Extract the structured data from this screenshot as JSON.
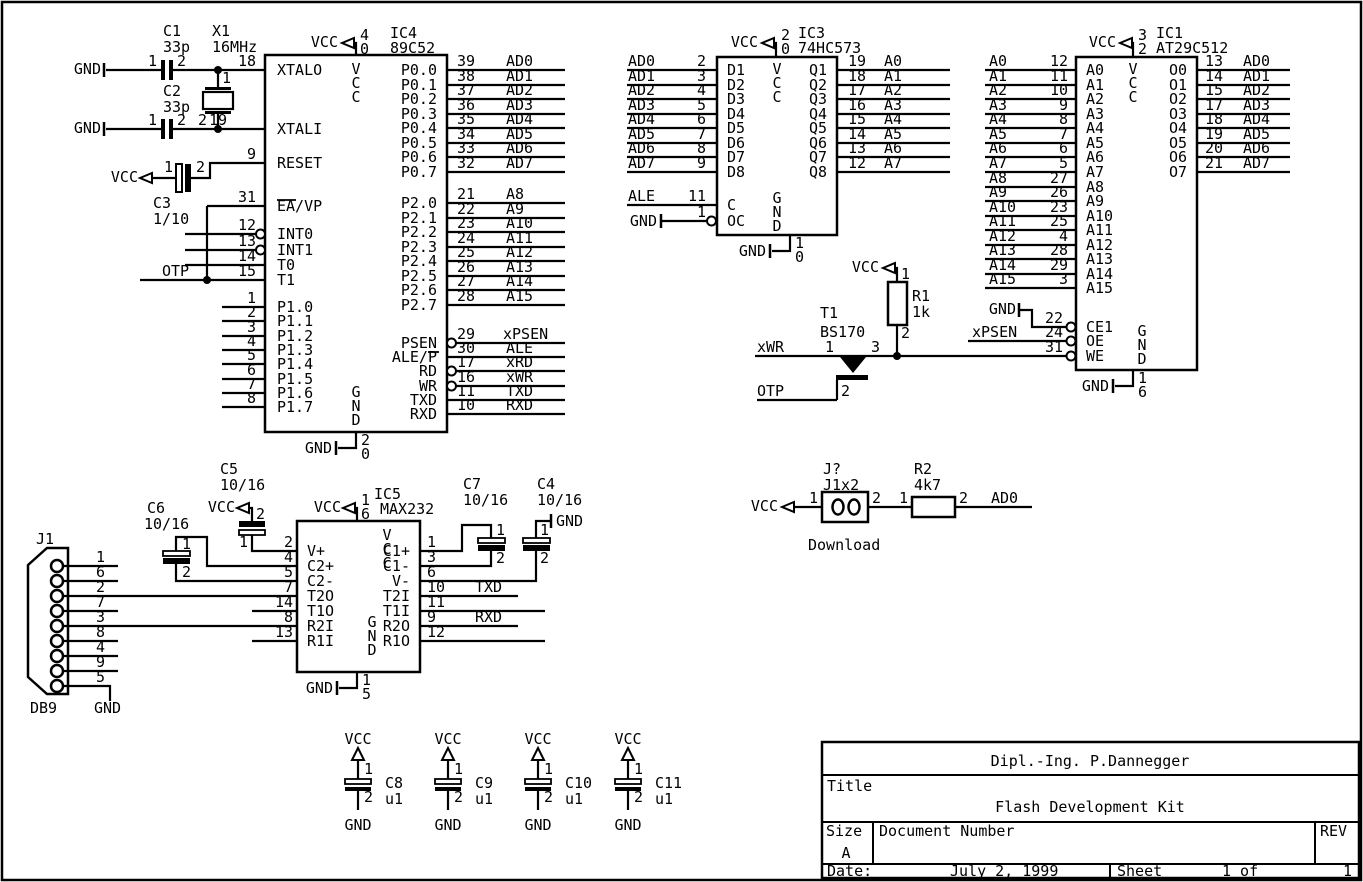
{
  "colors": {
    "background": "#ffffff",
    "ink": "#000000"
  },
  "net_labels": {
    "vcc": "VCC",
    "gnd": "GND",
    "otp": "OTP",
    "xwr": "xWR",
    "xpsen": "xPSEN",
    "txd": "TXD",
    "rxd": "RXD",
    "ad0": "AD0",
    "ale": "ALE"
  },
  "ics": {
    "ic4": {
      "ref": "IC4",
      "part": "89C52",
      "vcc_pin": [
        "4",
        "0"
      ],
      "gnd_pin": [
        "2",
        "0"
      ],
      "vcc_inside": "VCC",
      "gnd_inside": "GND",
      "left": [
        {
          "name": "XTALO",
          "num": "18"
        },
        {
          "name": "XTALI",
          "num": "19"
        },
        {
          "name": "RESET",
          "num": "9"
        },
        {
          "name": "EA/VP",
          "num": "31"
        },
        {
          "name": "INT0",
          "num": "12"
        },
        {
          "name": "INT1",
          "num": "13"
        },
        {
          "name": "T0",
          "num": "14"
        },
        {
          "name": "T1",
          "num": "15"
        },
        {
          "name": "P1.0",
          "num": "1"
        },
        {
          "name": "P1.1",
          "num": "2"
        },
        {
          "name": "P1.2",
          "num": "3"
        },
        {
          "name": "P1.3",
          "num": "4"
        },
        {
          "name": "P1.4",
          "num": "5"
        },
        {
          "name": "P1.5",
          "num": "6"
        },
        {
          "name": "P1.6",
          "num": "7"
        },
        {
          "name": "P1.7",
          "num": "8"
        }
      ],
      "right": [
        {
          "name": "P0.0",
          "num": "39",
          "net": "AD0"
        },
        {
          "name": "P0.1",
          "num": "38",
          "net": "AD1"
        },
        {
          "name": "P0.2",
          "num": "37",
          "net": "AD2"
        },
        {
          "name": "P0.3",
          "num": "36",
          "net": "AD3"
        },
        {
          "name": "P0.4",
          "num": "35",
          "net": "AD4"
        },
        {
          "name": "P0.5",
          "num": "34",
          "net": "AD5"
        },
        {
          "name": "P0.6",
          "num": "33",
          "net": "AD6"
        },
        {
          "name": "P0.7",
          "num": "32",
          "net": "AD7"
        },
        {
          "name": "P2.0",
          "num": "21",
          "net": "A8"
        },
        {
          "name": "P2.1",
          "num": "22",
          "net": "A9"
        },
        {
          "name": "P2.2",
          "num": "23",
          "net": "A10"
        },
        {
          "name": "P2.3",
          "num": "24",
          "net": "A11"
        },
        {
          "name": "P2.4",
          "num": "25",
          "net": "A12"
        },
        {
          "name": "P2.5",
          "num": "26",
          "net": "A13"
        },
        {
          "name": "P2.6",
          "num": "27",
          "net": "A14"
        },
        {
          "name": "P2.7",
          "num": "28",
          "net": "A15"
        },
        {
          "name": "PSEN",
          "num": "29",
          "net": "xPSEN"
        },
        {
          "name": "ALE/P",
          "num": "30",
          "net": "ALE"
        },
        {
          "name": "RD",
          "num": "17",
          "net": "xRD"
        },
        {
          "name": "WR",
          "num": "16",
          "net": "xWR"
        },
        {
          "name": "TXD",
          "num": "11",
          "net": "TXD"
        },
        {
          "name": "RXD",
          "num": "10",
          "net": "RXD"
        }
      ]
    },
    "ic3": {
      "ref": "IC3",
      "part": "74HC573",
      "vcc_pin": [
        "2",
        "0"
      ],
      "gnd_pin": [
        "1",
        "0"
      ],
      "vcc_inside": "VCC",
      "gnd_inside": "GND",
      "left": [
        {
          "name": "D1",
          "num": "2",
          "net": "AD0"
        },
        {
          "name": "D2",
          "num": "3",
          "net": "AD1"
        },
        {
          "name": "D3",
          "num": "4",
          "net": "AD2"
        },
        {
          "name": "D4",
          "num": "5",
          "net": "AD3"
        },
        {
          "name": "D5",
          "num": "6",
          "net": "AD4"
        },
        {
          "name": "D6",
          "num": "7",
          "net": "AD5"
        },
        {
          "name": "D7",
          "num": "8",
          "net": "AD6"
        },
        {
          "name": "D8",
          "num": "9",
          "net": "AD7"
        },
        {
          "name": "C",
          "num": "11",
          "net": "ALE"
        },
        {
          "name": "OC",
          "num": "1",
          "net": "GND"
        }
      ],
      "right": [
        {
          "name": "Q1",
          "num": "19",
          "net": "A0"
        },
        {
          "name": "Q2",
          "num": "18",
          "net": "A1"
        },
        {
          "name": "Q3",
          "num": "17",
          "net": "A2"
        },
        {
          "name": "Q4",
          "num": "16",
          "net": "A3"
        },
        {
          "name": "Q5",
          "num": "15",
          "net": "A4"
        },
        {
          "name": "Q6",
          "num": "14",
          "net": "A5"
        },
        {
          "name": "Q7",
          "num": "13",
          "net": "A6"
        },
        {
          "name": "Q8",
          "num": "12",
          "net": "A7"
        }
      ]
    },
    "ic1": {
      "ref": "IC1",
      "part": "AT29C512",
      "vcc_pin": [
        "3",
        "2"
      ],
      "gnd_pin": [
        "1",
        "6"
      ],
      "vcc_inside": "VCC",
      "gnd_inside": "GND",
      "left": [
        {
          "name": "A0",
          "num": "12"
        },
        {
          "name": "A1",
          "num": "11"
        },
        {
          "name": "A2",
          "num": "10"
        },
        {
          "name": "A3",
          "num": "9"
        },
        {
          "name": "A4",
          "num": "8"
        },
        {
          "name": "A5",
          "num": "7"
        },
        {
          "name": "A6",
          "num": "6"
        },
        {
          "name": "A7",
          "num": "5"
        },
        {
          "name": "A8",
          "num": "27"
        },
        {
          "name": "A9",
          "num": "26"
        },
        {
          "name": "A10",
          "num": "23"
        },
        {
          "name": "A11",
          "num": "25"
        },
        {
          "name": "A12",
          "num": "4"
        },
        {
          "name": "A13",
          "num": "28"
        },
        {
          "name": "A14",
          "num": "29"
        },
        {
          "name": "A15",
          "num": "3"
        }
      ],
      "ctrl": [
        {
          "name": "CE1",
          "num": "22",
          "net": "GND"
        },
        {
          "name": "OE",
          "num": "24",
          "net": "xPSEN"
        },
        {
          "name": "WE",
          "num": "31"
        }
      ],
      "right": [
        {
          "name": "O0",
          "num": "13",
          "net": "AD0"
        },
        {
          "name": "O1",
          "num": "14",
          "net": "AD1"
        },
        {
          "name": "O2",
          "num": "15",
          "net": "AD2"
        },
        {
          "name": "O3",
          "num": "17",
          "net": "AD3"
        },
        {
          "name": "O4",
          "num": "18",
          "net": "AD4"
        },
        {
          "name": "O5",
          "num": "19",
          "net": "AD5"
        },
        {
          "name": "O6",
          "num": "20",
          "net": "AD6"
        },
        {
          "name": "O7",
          "num": "21",
          "net": "AD7"
        }
      ]
    },
    "ic5": {
      "ref": "IC5",
      "part": "MAX232",
      "vcc_pin": [
        "1",
        "6"
      ],
      "gnd_pin": [
        "1",
        "5"
      ],
      "vcc_inside": "VCC",
      "gnd_inside": "GND",
      "left": [
        {
          "name": "V+",
          "num": "2"
        },
        {
          "name": "C2+",
          "num": "4"
        },
        {
          "name": "C2-",
          "num": "5"
        },
        {
          "name": "T2O",
          "num": "7"
        },
        {
          "name": "T1O",
          "num": "14"
        },
        {
          "name": "R2I",
          "num": "8"
        },
        {
          "name": "R1I",
          "num": "13"
        }
      ],
      "right": [
        {
          "name": "C1+",
          "num": "1"
        },
        {
          "name": "C1-",
          "num": "3"
        },
        {
          "name": "V-",
          "num": "6"
        },
        {
          "name": "T2I",
          "num": "10",
          "net": "TXD"
        },
        {
          "name": "T1I",
          "num": "11"
        },
        {
          "name": "R2O",
          "num": "9",
          "net": "RXD"
        },
        {
          "name": "R1O",
          "num": "12"
        }
      ]
    }
  },
  "parts": {
    "c1": {
      "ref": "C1",
      "val": "33p",
      "pins": [
        "1",
        "2"
      ]
    },
    "c2": {
      "ref": "C2",
      "val": "33p",
      "pins": [
        "1",
        "2"
      ]
    },
    "c3": {
      "ref": "C3",
      "val": "1/10",
      "pins": [
        "1",
        "2"
      ]
    },
    "x1": {
      "ref": "X1",
      "val": "16MHz",
      "pins": [
        "1",
        "2"
      ]
    },
    "r1": {
      "ref": "R1",
      "val": "1k",
      "pins": [
        "1",
        "2"
      ]
    },
    "r2": {
      "ref": "R2",
      "val": "4k7",
      "pins": [
        "1",
        "2"
      ]
    },
    "t1": {
      "ref": "T1",
      "val": "BS170",
      "pins": [
        "1",
        "2",
        "3"
      ]
    },
    "jp": {
      "ref": "J?",
      "val": "J1x2",
      "pins": [
        "1",
        "2"
      ],
      "caption": "Download"
    },
    "c5": {
      "ref": "C5",
      "val": "10/16",
      "pins": [
        "1",
        "2"
      ]
    },
    "c6": {
      "ref": "C6",
      "val": "10/16",
      "pins": [
        "1",
        "2"
      ]
    },
    "c7": {
      "ref": "C7",
      "val": "10/16",
      "pins": [
        "1",
        "2"
      ]
    },
    "c4": {
      "ref": "C4",
      "val": "10/16",
      "pins": [
        "1",
        "2"
      ]
    },
    "c8": {
      "ref": "C8",
      "val": "u1",
      "pins": [
        "1",
        "2"
      ]
    },
    "c9": {
      "ref": "C9",
      "val": "u1",
      "pins": [
        "1",
        "2"
      ]
    },
    "c10": {
      "ref": "C10",
      "val": "u1",
      "pins": [
        "1",
        "2"
      ]
    },
    "c11": {
      "ref": "C11",
      "val": "u1",
      "pins": [
        "1",
        "2"
      ]
    },
    "j1": {
      "ref": "J1",
      "type": "DB9",
      "pins": [
        "1",
        "6",
        "2",
        "7",
        "3",
        "8",
        "4",
        "9",
        "5"
      ]
    }
  },
  "title_block": {
    "author": "Dipl.-Ing. P.Dannegger",
    "title_label": "Title",
    "title": "Flash Development Kit",
    "size_label": "Size",
    "size": "A",
    "doc_label": "Document Number",
    "rev_label": "REV",
    "date_label": "Date:",
    "date": "July 2, 1999",
    "sheet_label": "Sheet",
    "sheet_of": "1 of",
    "sheet_total": "1"
  }
}
